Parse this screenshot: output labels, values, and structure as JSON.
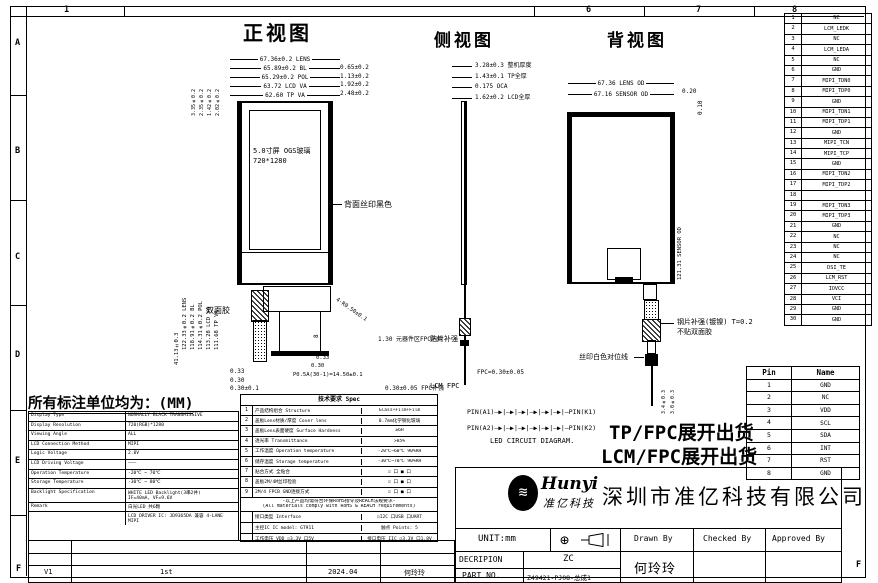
{
  "zones": {
    "top": [
      "1",
      "6",
      "7",
      "8"
    ],
    "left": [
      "A",
      "B",
      "C",
      "D",
      "E"
    ],
    "bottom_left": "F",
    "bottom_right": "F"
  },
  "units_note": "所有标注单位均为：(MM)",
  "views": {
    "front": {
      "title": "正视图",
      "top_dims": [
        "67.36±0.2 LENS",
        "65.89±0.2 BL",
        "65.29±0.2 POL",
        "63.72 LCD VA",
        "62.60 TP VA"
      ],
      "right_dims": [
        "0.65±0.2",
        "1.13±0.2",
        "1.92±0.2",
        "2.48±0.2"
      ],
      "left_top_dims": [
        "3.35±0.2",
        "2.35±0.2",
        "1.42±0.2",
        "2.02±0.2"
      ],
      "left_dims": [
        "122.33±0.2 LENS",
        "118.91±0.2 BL",
        "114.31±0.2 POL",
        "113.28 LCD VA",
        "111.68 TP VA"
      ],
      "fpc_unfold_dim": "41.13±0.3",
      "screen_line1": "5.0寸屏 OGS玻璃",
      "screen_line2": "720*1280",
      "back_print_label": "背面丝印黑色",
      "tape_label": "双面胶",
      "corner_radius": "4-R0.50±0.1",
      "fpc": {
        "dim_a": "0.33",
        "dim_b": "0.30",
        "dim_c": "0.33",
        "dim_d": "0.30",
        "dim_e": "0.30±0.1",
        "pitch": "P0.5A(30-1)=14.50±0.1",
        "height_dim": "8"
      },
      "note_component": "1.30 元器件区FPC内侧",
      "note_stiffener": "0.30±0.05 FPC补强"
    },
    "side": {
      "title": "侧视图",
      "dims": [
        "3.28±0.3 整机厚度",
        "1.43±0.1 TP全厚",
        "0.175 OCA",
        "1.62±0.2 LCD全厚"
      ],
      "label_top": "贴片补强",
      "label_mid": "FPC=0.30±0.05",
      "label_bot": "LCM FPC"
    },
    "back": {
      "title": "背视图",
      "top_dims": [
        "67.36 LENS OD",
        "67.16 SENSOR OD"
      ],
      "edge_dim_h": "0.20",
      "edge_dim_v": "0.10",
      "right_dim": "121.31 SENSOR OD",
      "stiffener_line1": "钢片补强(镀镍) T=0.2",
      "stiffener_line2": "不贴双面胶",
      "silk_label": "丝印白色对位线",
      "tail_dims": [
        "3.4±0.3",
        "3.0±0.3"
      ]
    }
  },
  "led": {
    "rows": [
      {
        "left": "PIN(A1)",
        "right": "PIN(K1)"
      },
      {
        "left": "PIN(A2)",
        "right": "PIN(K2)"
      }
    ],
    "diodes": "―▶|―▶|―▶|―▶|―▶|―▶|―",
    "caption": "LED CIRCUIT DIAGRAM."
  },
  "shipping": [
    "TP/FPC展开出货",
    "LCM/FPC展开出货"
  ],
  "lcm_pins": {
    "rows": [
      {
        "n": "1",
        "name": "NC"
      },
      {
        "n": "2",
        "name": "LCM_LEDK"
      },
      {
        "n": "3",
        "name": "NC"
      },
      {
        "n": "4",
        "name": "LCM_LEDA"
      },
      {
        "n": "5",
        "name": "NC"
      },
      {
        "n": "6",
        "name": "GND"
      },
      {
        "n": "7",
        "name": "MIPI_TDN0"
      },
      {
        "n": "8",
        "name": "MIPI_TDP0"
      },
      {
        "n": "9",
        "name": "GND"
      },
      {
        "n": "10",
        "name": "MIPI_TDN1"
      },
      {
        "n": "11",
        "name": "MIPI_TDP1"
      },
      {
        "n": "12",
        "name": "GND"
      },
      {
        "n": "13",
        "name": "MIPI_TCN"
      },
      {
        "n": "14",
        "name": "MIPI_TCP"
      },
      {
        "n": "15",
        "name": "GND"
      },
      {
        "n": "16",
        "name": "MIPI_TDN2"
      },
      {
        "n": "17",
        "name": "MIPI_TDP2"
      },
      {
        "n": "18",
        "name": ""
      },
      {
        "n": "19",
        "name": "MIPI_TDN3"
      },
      {
        "n": "20",
        "name": "MIPI_TDP3"
      },
      {
        "n": "21",
        "name": "GND"
      },
      {
        "n": "22",
        "name": "NC"
      },
      {
        "n": "23",
        "name": "NC"
      },
      {
        "n": "24",
        "name": "NC"
      },
      {
        "n": "25",
        "name": "DSI_TE"
      },
      {
        "n": "26",
        "name": "LCM_RST"
      },
      {
        "n": "27",
        "name": "IOVCC"
      },
      {
        "n": "28",
        "name": "VCI"
      },
      {
        "n": "29",
        "name": "GND"
      },
      {
        "n": "30",
        "name": "GND"
      }
    ]
  },
  "tp_pins": {
    "h1": "Pin",
    "h2": "Name",
    "rows": [
      {
        "n": "1",
        "name": "GND"
      },
      {
        "n": "2",
        "name": "NC"
      },
      {
        "n": "3",
        "name": "VDD"
      },
      {
        "n": "4",
        "name": "SCL"
      },
      {
        "n": "5",
        "name": "SDA"
      },
      {
        "n": "6",
        "name": "INT"
      },
      {
        "n": "7",
        "name": "RST"
      },
      {
        "n": "8",
        "name": "GND"
      }
    ]
  },
  "lcm_spec": {
    "rows": [
      {
        "label": "Display Type",
        "value": "NORMALLY BLACK TRANSMISSIVE"
      },
      {
        "label": "Display Resolution",
        "value": "720(RGB)*1280"
      },
      {
        "label": "Viewing Angle",
        "value": "ALL"
      },
      {
        "label": "LCD Connection Method",
        "value": "MIPI"
      },
      {
        "label": "Logic Voltage",
        "value": "2.8V"
      },
      {
        "label": "LCD Driving Voltage",
        "value": "———"
      },
      {
        "label": "Operation Temperature",
        "value": "-20℃ ~ 70℃"
      },
      {
        "label": "Storage Temperature",
        "value": "-30℃ ~ 80℃"
      },
      {
        "label": "Backlight Specification",
        "value": "WHITE LED Backlight(3串2并)\nIF=40mA, VF=9.6V"
      },
      {
        "label": "Remark",
        "value": "白光LED 共6颗"
      },
      {
        "label": "",
        "value": "LCD DRIVER IC: JD9365DA 兼容 4-LANE MIPI"
      }
    ]
  },
  "tp_spec": {
    "title": "技术要求 Spec",
    "rows1": [
      {
        "n": "1",
        "label": "产品结构组合 Structure",
        "value": "Glass+Film+Film"
      },
      {
        "n": "2",
        "label": "盖板Lens材质/厚度 Cover lens",
        "value": "0.7mm化学钢化玻璃"
      },
      {
        "n": "3",
        "label": "盖板Lens表面硬度 Surface Hardness",
        "value": "≥6H"
      },
      {
        "n": "4",
        "label": "透光率 Transmittance",
        "value": ">85%"
      },
      {
        "n": "5",
        "label": "工作温度 Operation temperature",
        "value": "-20℃~60℃ 90%RH"
      },
      {
        "n": "6",
        "label": "储存温度 Storage temperature",
        "value": "-30℃~70℃ 90%RH"
      },
      {
        "n": "7",
        "label": "贴合方式 全贴合",
        "value": "☑ 口   ■ 口"
      },
      {
        "n": "8",
        "label": "盖板2M/4M丝印检验",
        "value": "☑ 口   ■ 口"
      },
      {
        "n": "9",
        "label": "2M/4 FPCB GND连接方式",
        "value": "☑ 口   ■ 口"
      }
    ],
    "note1": "-以上产品均需符合环保RoHS指令及REACH法规要求-",
    "note2": "(All materials comply with RoHS & REACH requirements)",
    "rows2": [
      {
        "n": "",
        "label": "接口类型 Interface",
        "value": "☑I2C  口USB  口UART"
      },
      {
        "n": "",
        "label": "主控IC IC model: GT911",
        "value": "触点 Points: 5"
      },
      {
        "n": "",
        "label": "工作电压 VDD ☑3.3V 口5V",
        "value": "接口电压 IIC ☑3.3V 口1.8V"
      },
      {
        "n": "",
        "label": "SDA,SCL上拉电阻已上拉 Connection",
        "value": "☑有 Yes  口无 No"
      }
    ]
  },
  "title_block": {
    "brand": "Hunyi",
    "brand_cn": "准亿科技",
    "company": "深圳市准亿科技有限公司",
    "unit": "UNIT:mm",
    "drawn_by": "Drawn By",
    "checked_by": "Checked By",
    "approved_by": "Approved By",
    "decripion_label": "DECRIPION",
    "decripion": "ZC",
    "part_label": "PART NO.",
    "part_no": "Z49421-PJ08-总成1",
    "drawn_name": "何玲玲"
  },
  "revision": {
    "version": "V1",
    "desc": "1st",
    "date": "2024.04",
    "name": "何玲玲"
  }
}
